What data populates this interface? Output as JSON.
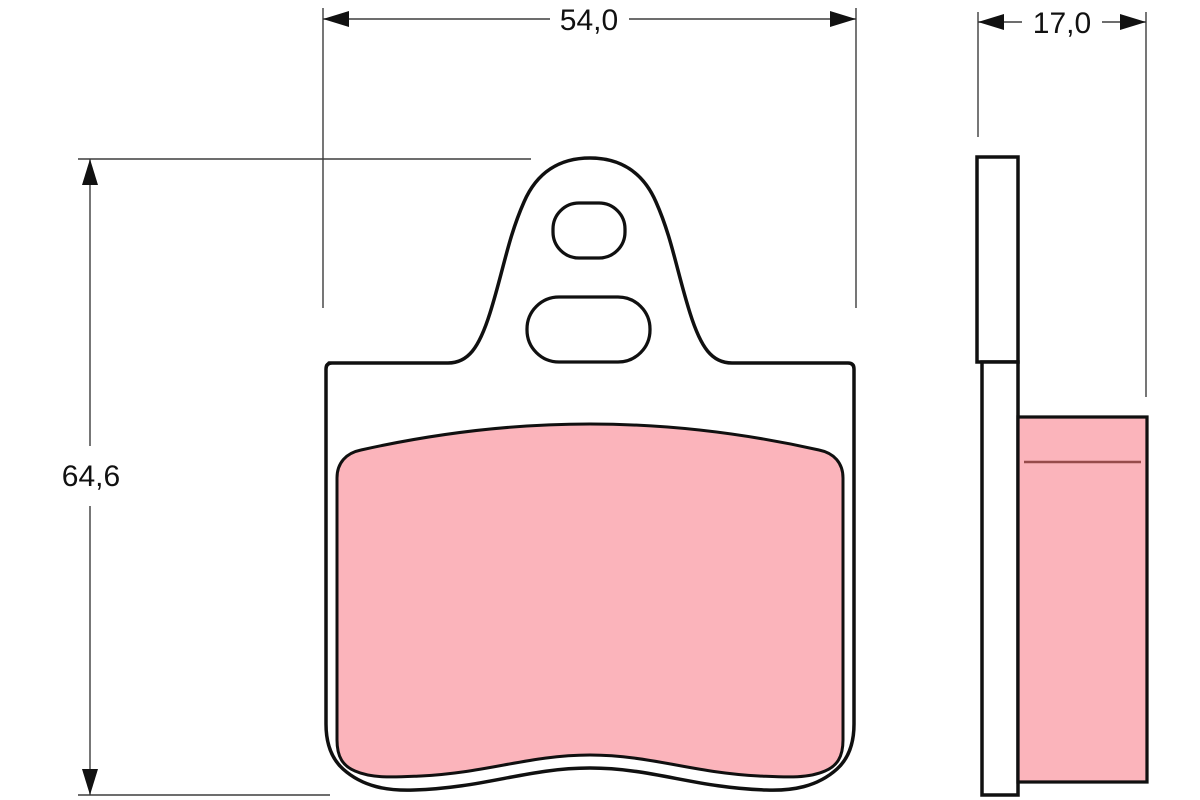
{
  "dimensions": {
    "width_label": "54,0",
    "thickness_label": "17,0",
    "height_label": "64,6"
  },
  "colors": {
    "background": "#ffffff",
    "outline": "#101010",
    "dimension_line": "#3d3d3d",
    "friction_material": "#fbb4bb",
    "friction_surface_line": "#964b4b"
  }
}
